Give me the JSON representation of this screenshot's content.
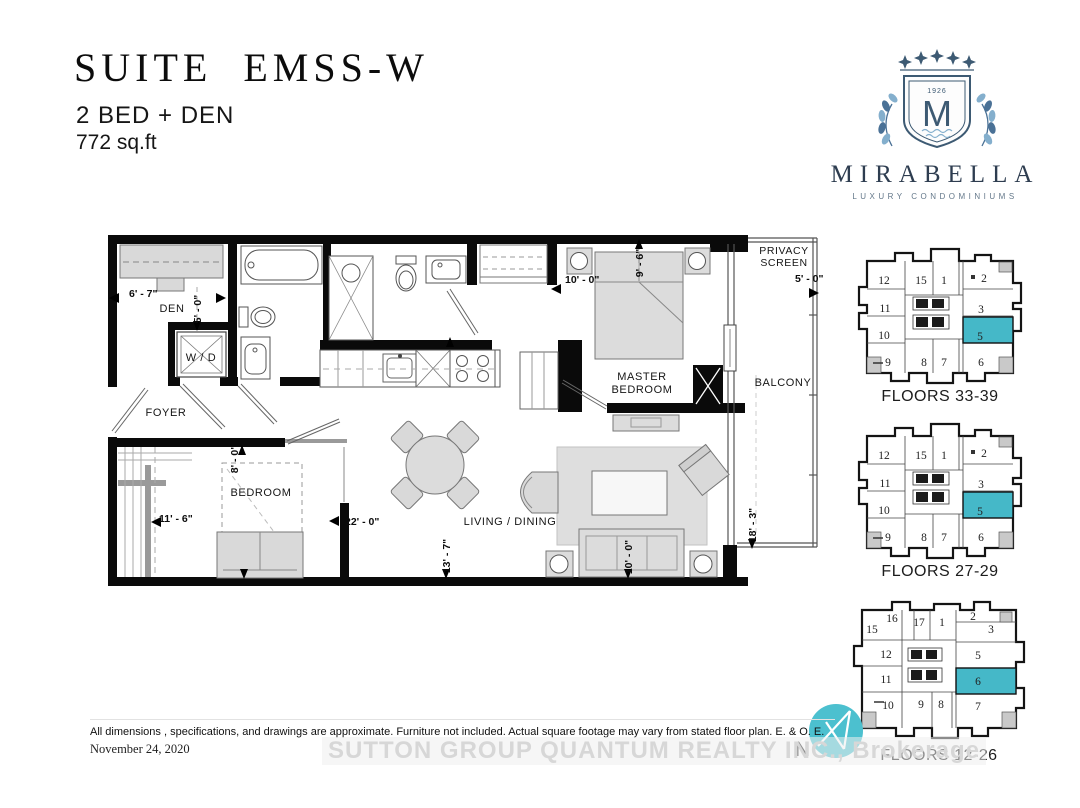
{
  "header": {
    "suite": "SUITE EMSS-W",
    "config": "2 BED + DEN",
    "area": "772 sq.ft"
  },
  "logo": {
    "brand": "MIRABELLA",
    "tagline": "LUXURY CONDOMINIUMS",
    "monogram": "M",
    "year": "1926"
  },
  "plan": {
    "labels": {
      "den": "DEN",
      "wd": "W / D",
      "foyer": "FOYER",
      "bedroom": "BEDROOM",
      "master1": "MASTER",
      "master2": "BEDROOM",
      "living": "LIVING / DINING",
      "balcony": "BALCONY",
      "privacy1": "PRIVACY",
      "privacy2": "SCREEN"
    },
    "dims": {
      "den_w": "6' - 7\"",
      "den_h": "5' - 0\"",
      "master_w": "10' - 0\"",
      "master_h": "9' - 6\"",
      "balcony_w": "5' - 0\"",
      "bedroom_w": "11' - 6\"",
      "bedroom_h": "8' - 0\"",
      "living_w": "22' - 0\"",
      "media_h": "13' - 7\"",
      "sofa_w": "10' - 0\"",
      "balcony_h": "18' - 3\""
    }
  },
  "key_plans": [
    {
      "title": "FLOORS 33-39",
      "highlighted_unit": "5",
      "units": [
        "12",
        "15",
        "1",
        "2",
        "11",
        "3",
        "10",
        "5",
        "9",
        "8",
        "7",
        "6"
      ]
    },
    {
      "title": "FLOORS 27-29",
      "highlighted_unit": "5",
      "units": [
        "12",
        "15",
        "1",
        "2",
        "11",
        "3",
        "10",
        "5",
        "9",
        "8",
        "7",
        "6"
      ]
    },
    {
      "title": "FLOORS 12-26",
      "highlighted_unit": "6",
      "units": [
        "16",
        "17",
        "1",
        "2",
        "15",
        "3",
        "12",
        "5",
        "11",
        "6",
        "10",
        "9",
        "8",
        "7"
      ]
    }
  ],
  "footer": {
    "disclaimer": "All dimensions , specifications, and drawings are approximate. Furniture not included. Actual square footage may vary from stated floor plan. E. & O. E.",
    "date": "November 24, 2020",
    "watermark": "SUTTON GROUP QUANTUM REALTY INC., Brokerage",
    "north": "N"
  },
  "colors": {
    "highlight": "#45b8c8",
    "logo_navy": "#3d5a73",
    "logo_blue": "#84afcd",
    "north_teal": "#4cc0cf"
  }
}
